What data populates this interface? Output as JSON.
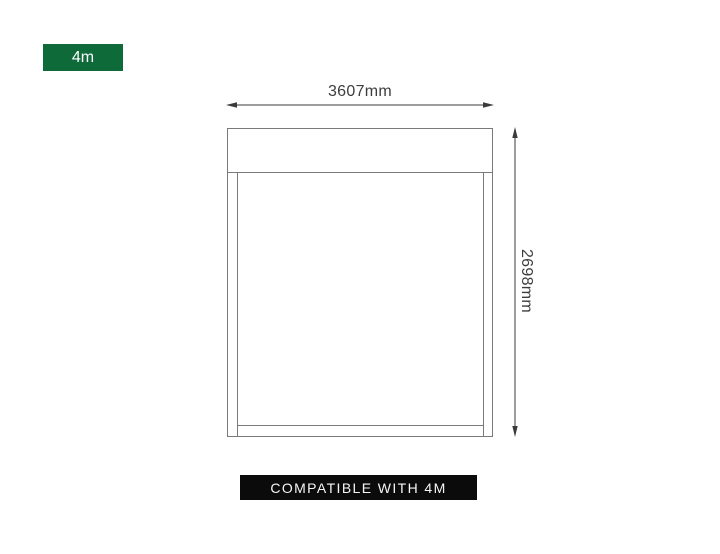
{
  "size_badge": {
    "label": "4m",
    "bg_color": "#0f6a3a",
    "text_color": "#ffffff"
  },
  "dimensions": {
    "width_label": "3607mm",
    "height_label": "2698mm"
  },
  "compatibility_badge": {
    "label": "COMPATIBLE WITH 4M",
    "bg_color": "#0b0b0b",
    "text_color": "#f5f5f5"
  },
  "diagram": {
    "type": "product-dimension-drawing",
    "frame_line_color": "#7a7a7a",
    "dimension_line_color": "#3b3b3b",
    "dimension_text_color": "#3d3d3d",
    "icons": {
      "width_arrow": "horizontal-double-headed-arrow",
      "height_arrow": "vertical-double-headed-arrow"
    }
  }
}
